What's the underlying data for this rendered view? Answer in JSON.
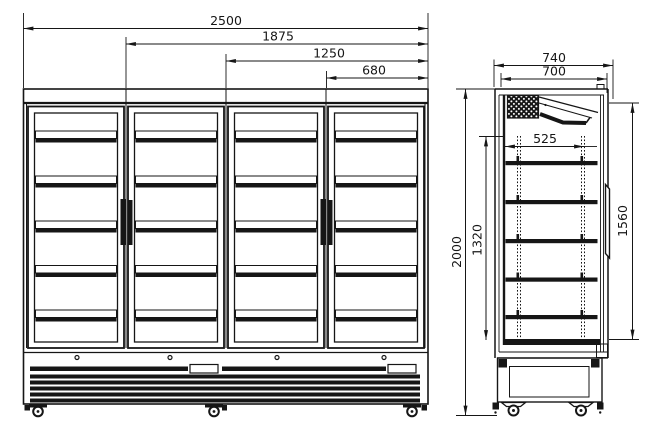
{
  "drawing": {
    "type": "technical-dimension-drawing",
    "subject": "four glass door upright display cooler, front and side elevations",
    "line_color": "#161616",
    "background_color": "#ffffff"
  },
  "front_view": {
    "door_count": 4,
    "shelves_per_door": 5,
    "dims": {
      "overall_width": "2500",
      "three_door_span": "1875",
      "two_door_span": "1250",
      "door_span": "680"
    }
  },
  "side_view": {
    "shelf_levels": 5,
    "dims": {
      "overall_depth": "740",
      "body_depth": "700",
      "shelf_depth": "525",
      "overall_height": "2000",
      "interior_height": "1320",
      "door_height": "1560"
    }
  }
}
